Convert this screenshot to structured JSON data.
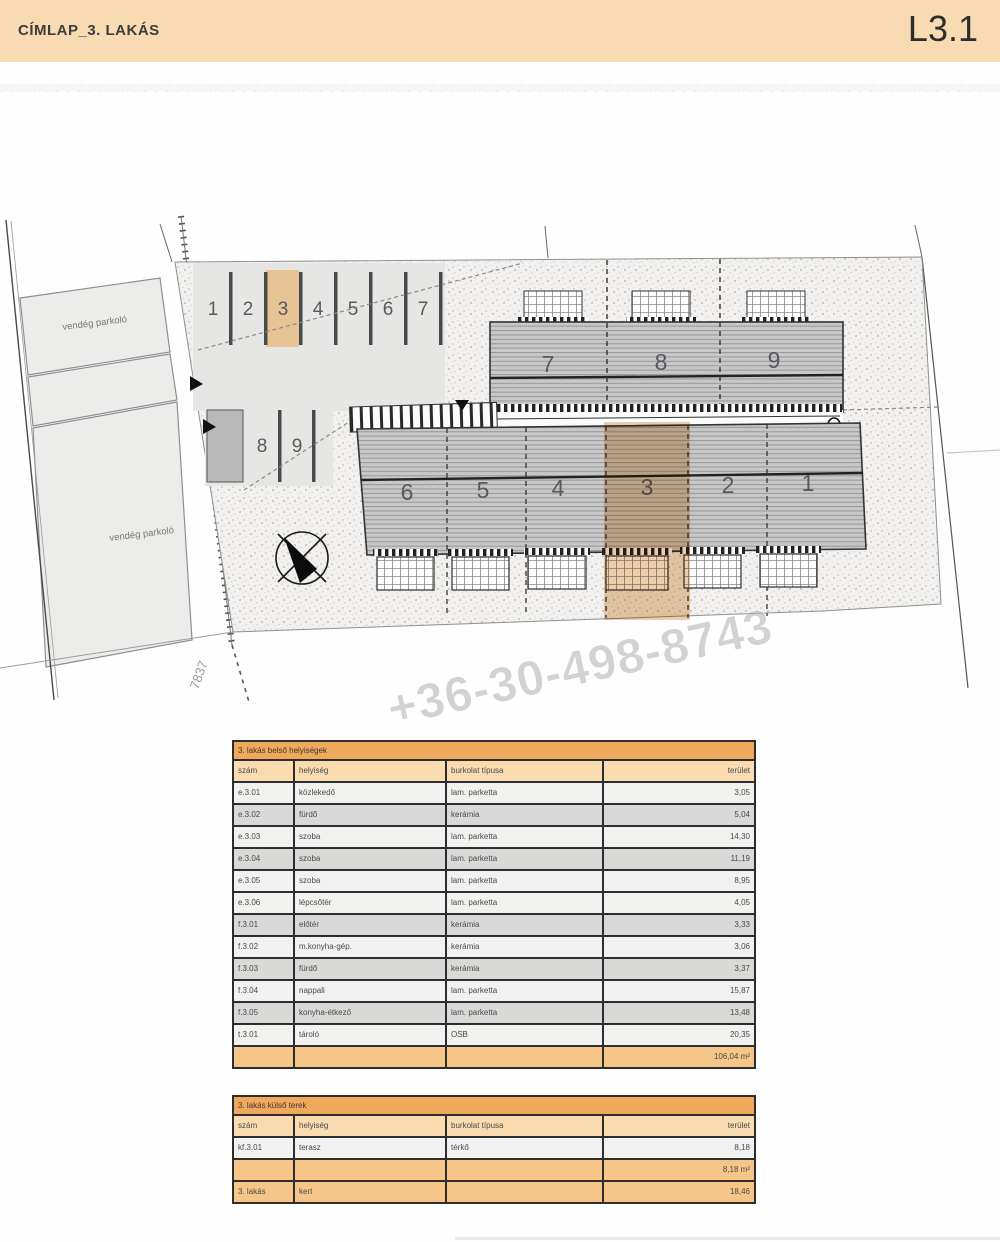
{
  "header": {
    "title": "CÍMLAP_3. LAKÁS",
    "sheet": "L3.1"
  },
  "plan": {
    "guest_parking_label_1": "vendég parkoló",
    "guest_parking_label_2": "vendég parkoló",
    "parcel_number": "7837",
    "parking_spaces": [
      "1",
      "2",
      "3",
      "4",
      "5",
      "6",
      "7"
    ],
    "parking_spaces_lower": [
      "8",
      "9"
    ],
    "upper_units": [
      "7",
      "8",
      "9"
    ],
    "lower_units": [
      "6",
      "5",
      "4",
      "3",
      "2",
      "1"
    ],
    "watermark": "+36-30-498-8743",
    "highlight_color": "#e0a868"
  },
  "tables": {
    "interior": {
      "title": "3. lakás belső helyiségek",
      "columns": [
        "szám",
        "helyiség",
        "burkolat típusa",
        "terület"
      ],
      "rows": [
        {
          "num": "e.3.01",
          "name": "közlekedő",
          "floor": "lam. parketta",
          "area": "3,05"
        },
        {
          "num": "e.3.02",
          "name": "fürdő",
          "floor": "kerámia",
          "area": "5,04"
        },
        {
          "num": "e.3.03",
          "name": "szoba",
          "floor": "lam. parketta",
          "area": "14,30"
        },
        {
          "num": "e.3.04",
          "name": "szoba",
          "floor": "lam. parketta",
          "area": "11,19"
        },
        {
          "num": "e.3.05",
          "name": "szoba",
          "floor": "lam. parketta",
          "area": "8,95"
        },
        {
          "num": "e.3.06",
          "name": "lépcsőtér",
          "floor": "lam. parketta",
          "area": "4,05"
        },
        {
          "num": "f.3.01",
          "name": "előtér",
          "floor": "kerámia",
          "area": "3,33"
        },
        {
          "num": "f.3.02",
          "name": "m.konyha-gép.",
          "floor": "kerámia",
          "area": "3,06"
        },
        {
          "num": "f.3.03",
          "name": "fürdő",
          "floor": "kerámia",
          "area": "3,37"
        },
        {
          "num": "f.3.04",
          "name": "nappali",
          "floor": "lam. parketta",
          "area": "15,87"
        },
        {
          "num": "f.3.05",
          "name": "konyha-étkező",
          "floor": "lam. parketta",
          "area": "13,48"
        },
        {
          "num": "t.3.01",
          "name": "tároló",
          "floor": "OSB",
          "area": "20,35"
        }
      ],
      "total": "106,04 m²"
    },
    "exterior": {
      "title": "3. lakás külső terek",
      "columns": [
        "szám",
        "helyiség",
        "burkolat típusa",
        "terület"
      ],
      "rows": [
        {
          "num": "kf.3.01",
          "name": "terasz",
          "floor": "térkő",
          "area": "8,18"
        }
      ],
      "subtotal": "8,18 m²",
      "garden_row": {
        "num": "3. lakás",
        "name": "kert",
        "floor": "",
        "area": "18,46"
      }
    }
  }
}
